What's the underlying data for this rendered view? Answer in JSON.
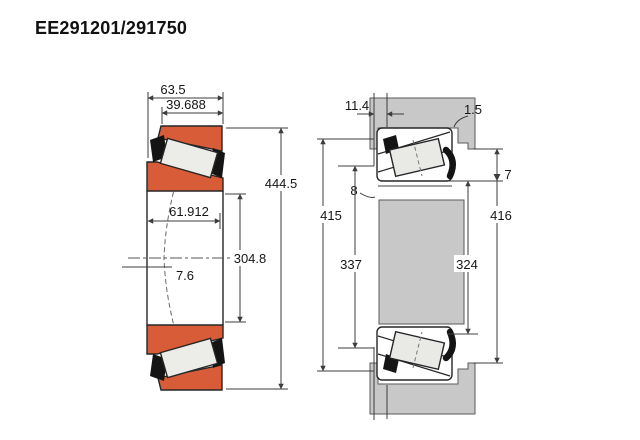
{
  "title": "EE291201/291750",
  "colors": {
    "ring_orange": "#D85C38",
    "steel_gray": "#C8C8C8",
    "roller_light": "#ECECE8",
    "outline": "#262626",
    "dim_line": "#3c3c3c"
  },
  "left_diagram": {
    "labels": {
      "width_total": "63.5",
      "width_cup": "39.688",
      "width_cone": "61.912",
      "outer_diameter": "444.5",
      "bore_diameter": "304.8",
      "center_offset": "7.6"
    }
  },
  "right_diagram": {
    "labels": {
      "axial_offset": "11.4",
      "fillet_housing": "1.5",
      "fillet_shaft": "8",
      "housing_bore": "415",
      "shaft_shoulder": "337",
      "backing_shoulder": "324",
      "housing_shoulder": "416",
      "shoulder_clearance": "7"
    }
  }
}
